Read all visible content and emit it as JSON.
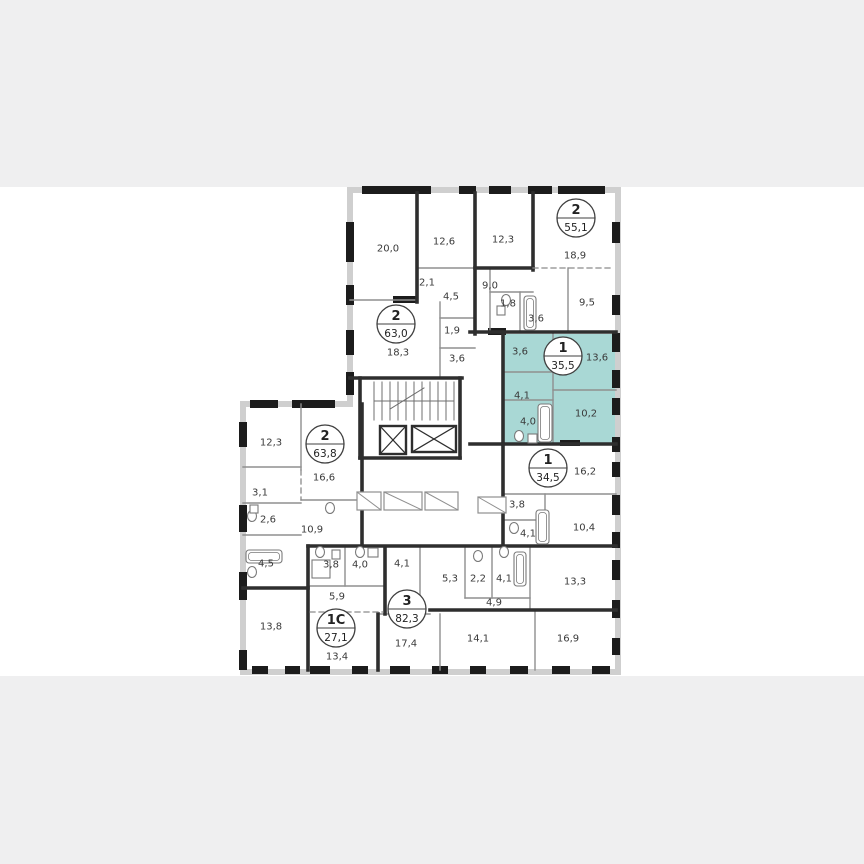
{
  "page": {
    "background": "#ffffff",
    "band_color": "#efeff0",
    "top_band": {
      "x": 0,
      "y": 0,
      "w": 864,
      "h": 187
    },
    "bottom_band": {
      "x": 0,
      "y": 676,
      "w": 864,
      "h": 188
    }
  },
  "colors": {
    "highlight_fill": "#a9d8d5",
    "wall_dark": "#2e2e2e",
    "wall_thin": "#8f8f8f",
    "wall_ext": "#cfcfcf",
    "window_block": "#1c1c1c",
    "label_text": "#3a3a3a",
    "fixture_stroke": "#7a7a7a",
    "dash_color": "#8a8a8a"
  },
  "plan": {
    "highlight": {
      "name": "selected-apartment",
      "rect": [
        504,
        334,
        112,
        110
      ]
    },
    "units": [
      {
        "type": "2",
        "area": "55,1",
        "cx": 576,
        "cy": 218
      },
      {
        "type": "2",
        "area": "63,0",
        "cx": 396,
        "cy": 324
      },
      {
        "type": "1",
        "area": "35,5",
        "cx": 563,
        "cy": 356,
        "highlighted": true
      },
      {
        "type": "2",
        "area": "63,8",
        "cx": 325,
        "cy": 444
      },
      {
        "type": "1",
        "area": "34,5",
        "cx": 548,
        "cy": 468
      },
      {
        "type": "3",
        "area": "82,3",
        "cx": 407,
        "cy": 609
      },
      {
        "type": "1C",
        "area": "27,1",
        "cx": 336,
        "cy": 628
      }
    ],
    "rooms": [
      {
        "label": "20,0",
        "x": 388,
        "y": 248
      },
      {
        "label": "12,6",
        "x": 444,
        "y": 241
      },
      {
        "label": "12,3",
        "x": 503,
        "y": 239
      },
      {
        "label": "18,9",
        "x": 575,
        "y": 255
      },
      {
        "label": "2,1",
        "x": 427,
        "y": 282
      },
      {
        "label": "4,5",
        "x": 451,
        "y": 296
      },
      {
        "label": "9,0",
        "x": 490,
        "y": 285
      },
      {
        "label": "1,8",
        "x": 508,
        "y": 303
      },
      {
        "label": "3,6",
        "x": 536,
        "y": 318
      },
      {
        "label": "9,5",
        "x": 587,
        "y": 302
      },
      {
        "label": "1,9",
        "x": 452,
        "y": 330
      },
      {
        "label": "18,3",
        "x": 398,
        "y": 352
      },
      {
        "label": "3,6",
        "x": 457,
        "y": 358
      },
      {
        "label": "3,6",
        "x": 520,
        "y": 351
      },
      {
        "label": "13,6",
        "x": 597,
        "y": 357
      },
      {
        "label": "4,1",
        "x": 522,
        "y": 395
      },
      {
        "label": "4,0",
        "x": 528,
        "y": 421
      },
      {
        "label": "10,2",
        "x": 586,
        "y": 413
      },
      {
        "label": "16,2",
        "x": 585,
        "y": 471
      },
      {
        "label": "3,8",
        "x": 517,
        "y": 504
      },
      {
        "label": "4,1",
        "x": 528,
        "y": 533
      },
      {
        "label": "10,4",
        "x": 584,
        "y": 527
      },
      {
        "label": "12,3",
        "x": 271,
        "y": 442
      },
      {
        "label": "16,6",
        "x": 324,
        "y": 477
      },
      {
        "label": "3,1",
        "x": 260,
        "y": 492
      },
      {
        "label": "2,6",
        "x": 268,
        "y": 519
      },
      {
        "label": "10,9",
        "x": 312,
        "y": 529
      },
      {
        "label": "4,5",
        "x": 266,
        "y": 563
      },
      {
        "label": "13,8",
        "x": 271,
        "y": 626
      },
      {
        "label": "3,8",
        "x": 331,
        "y": 564
      },
      {
        "label": "4,0",
        "x": 360,
        "y": 564
      },
      {
        "label": "5,9",
        "x": 337,
        "y": 596
      },
      {
        "label": "13,4",
        "x": 337,
        "y": 656
      },
      {
        "label": "4,1",
        "x": 402,
        "y": 563
      },
      {
        "label": "5,3",
        "x": 450,
        "y": 578
      },
      {
        "label": "2,2",
        "x": 478,
        "y": 578
      },
      {
        "label": "4,1",
        "x": 504,
        "y": 578
      },
      {
        "label": "13,3",
        "x": 575,
        "y": 581
      },
      {
        "label": "4,9",
        "x": 494,
        "y": 602
      },
      {
        "label": "17,4",
        "x": 406,
        "y": 643
      },
      {
        "label": "14,1",
        "x": 478,
        "y": 638
      },
      {
        "label": "16,9",
        "x": 568,
        "y": 638
      }
    ],
    "walls_ext": [
      [
        350,
        190,
        618,
        190
      ],
      [
        618,
        190,
        618,
        672
      ],
      [
        243,
        672,
        618,
        672
      ],
      [
        243,
        404,
        243,
        672
      ],
      [
        243,
        404,
        350,
        404
      ],
      [
        350,
        190,
        350,
        404
      ]
    ],
    "windows": [
      [
        362,
        186,
        69,
        8
      ],
      [
        459,
        186,
        17,
        8
      ],
      [
        489,
        186,
        22,
        8
      ],
      [
        528,
        186,
        24,
        8
      ],
      [
        558,
        186,
        47,
        8
      ],
      [
        612,
        222,
        8,
        21
      ],
      [
        612,
        295,
        8,
        20
      ],
      [
        612,
        333,
        8,
        19
      ],
      [
        612,
        370,
        8,
        18
      ],
      [
        612,
        398,
        8,
        17
      ],
      [
        612,
        437,
        8,
        15
      ],
      [
        612,
        462,
        8,
        15
      ],
      [
        612,
        495,
        8,
        20
      ],
      [
        612,
        532,
        8,
        16
      ],
      [
        612,
        560,
        8,
        20
      ],
      [
        612,
        600,
        8,
        18
      ],
      [
        612,
        638,
        8,
        17
      ],
      [
        252,
        666,
        16,
        8
      ],
      [
        285,
        666,
        15,
        8
      ],
      [
        310,
        666,
        20,
        8
      ],
      [
        352,
        666,
        16,
        8
      ],
      [
        390,
        666,
        20,
        8
      ],
      [
        432,
        666,
        16,
        8
      ],
      [
        470,
        666,
        16,
        8
      ],
      [
        510,
        666,
        18,
        8
      ],
      [
        552,
        666,
        18,
        8
      ],
      [
        592,
        666,
        18,
        8
      ],
      [
        239,
        422,
        8,
        25
      ],
      [
        239,
        505,
        8,
        27
      ],
      [
        239,
        572,
        8,
        28
      ],
      [
        239,
        650,
        8,
        20
      ],
      [
        250,
        400,
        28,
        8
      ],
      [
        292,
        400,
        43,
        8
      ],
      [
        346,
        222,
        8,
        40
      ],
      [
        346,
        285,
        8,
        20
      ],
      [
        346,
        330,
        8,
        25
      ],
      [
        346,
        372,
        8,
        23
      ],
      [
        393,
        296,
        24,
        7
      ],
      [
        488,
        328,
        18,
        7
      ],
      [
        560,
        440,
        20,
        6
      ]
    ],
    "walls_thick": [
      [
        417,
        193,
        417,
        302
      ],
      [
        475,
        193,
        475,
        334
      ],
      [
        533,
        193,
        533,
        270
      ],
      [
        475,
        268,
        533,
        268
      ],
      [
        470,
        332,
        616,
        332
      ],
      [
        503,
        334,
        503,
        444
      ],
      [
        470,
        444,
        616,
        444
      ],
      [
        350,
        378,
        462,
        378
      ],
      [
        360,
        378,
        360,
        458
      ],
      [
        460,
        378,
        460,
        458
      ],
      [
        360,
        458,
        460,
        458
      ],
      [
        362,
        404,
        362,
        548
      ],
      [
        308,
        546,
        308,
        670
      ],
      [
        243,
        588,
        308,
        588
      ],
      [
        308,
        546,
        616,
        546
      ],
      [
        385,
        548,
        385,
        614
      ],
      [
        378,
        614,
        378,
        670
      ],
      [
        430,
        610,
        616,
        610
      ],
      [
        503,
        444,
        503,
        546
      ]
    ],
    "walls_thin": [
      [
        350,
        300,
        417,
        300
      ],
      [
        417,
        268,
        475,
        268
      ],
      [
        440,
        302,
        440,
        378
      ],
      [
        440,
        318,
        475,
        318
      ],
      [
        440,
        348,
        475,
        348
      ],
      [
        490,
        270,
        490,
        332
      ],
      [
        490,
        292,
        533,
        292
      ],
      [
        520,
        292,
        520,
        332
      ],
      [
        568,
        268,
        568,
        332
      ],
      [
        553,
        334,
        553,
        444
      ],
      [
        503,
        372,
        553,
        372
      ],
      [
        503,
        400,
        553,
        400
      ],
      [
        553,
        390,
        616,
        390
      ],
      [
        503,
        494,
        616,
        494
      ],
      [
        545,
        494,
        545,
        546
      ],
      [
        503,
        520,
        545,
        520
      ],
      [
        301,
        404,
        301,
        470
      ],
      [
        243,
        467,
        301,
        467
      ],
      [
        243,
        503,
        301,
        503
      ],
      [
        243,
        535,
        301,
        535
      ],
      [
        301,
        500,
        362,
        500
      ],
      [
        345,
        548,
        345,
        586
      ],
      [
        308,
        586,
        385,
        586
      ],
      [
        420,
        548,
        420,
        610
      ],
      [
        465,
        548,
        465,
        598
      ],
      [
        492,
        548,
        492,
        598
      ],
      [
        530,
        548,
        530,
        610
      ],
      [
        465,
        598,
        530,
        598
      ],
      [
        440,
        614,
        440,
        670
      ],
      [
        535,
        610,
        535,
        670
      ],
      [
        378,
        614,
        430,
        614
      ]
    ],
    "dashed": [
      [
        533,
        268,
        614,
        268
      ],
      [
        310,
        612,
        383,
        612
      ],
      [
        301,
        470,
        301,
        500
      ]
    ],
    "closets": [
      [
        357,
        492,
        24,
        18
      ],
      [
        384,
        492,
        38,
        18
      ],
      [
        425,
        492,
        33,
        18
      ],
      [
        478,
        497,
        28,
        16
      ]
    ],
    "stairs": {
      "x1": 374,
      "x2": 454,
      "y1": 382,
      "y2": 420,
      "treads": 11,
      "mid_y": 401
    },
    "elevators": [
      [
        380,
        426,
        26,
        28
      ],
      [
        412,
        426,
        44,
        26
      ]
    ],
    "fixtures": {
      "tubs": [
        [
          538,
          404,
          14,
          38
        ],
        [
          524,
          296,
          12,
          34
        ],
        [
          536,
          510,
          13,
          34
        ],
        [
          246,
          550,
          36,
          13
        ],
        [
          514,
          552,
          12,
          34
        ]
      ],
      "sinks": [
        [
          519,
          436
        ],
        [
          506,
          300
        ],
        [
          514,
          528
        ],
        [
          252,
          516
        ],
        [
          252,
          572
        ],
        [
          320,
          552
        ],
        [
          478,
          556
        ],
        [
          504,
          552
        ],
        [
          360,
          552
        ],
        [
          330,
          508
        ]
      ],
      "boxes": [
        [
          528,
          434,
          9,
          9
        ],
        [
          497,
          306,
          8,
          9
        ],
        [
          312,
          560,
          18,
          18
        ],
        [
          332,
          550,
          8,
          9
        ],
        [
          250,
          505,
          8,
          8
        ],
        [
          368,
          548,
          10,
          9
        ]
      ]
    }
  }
}
